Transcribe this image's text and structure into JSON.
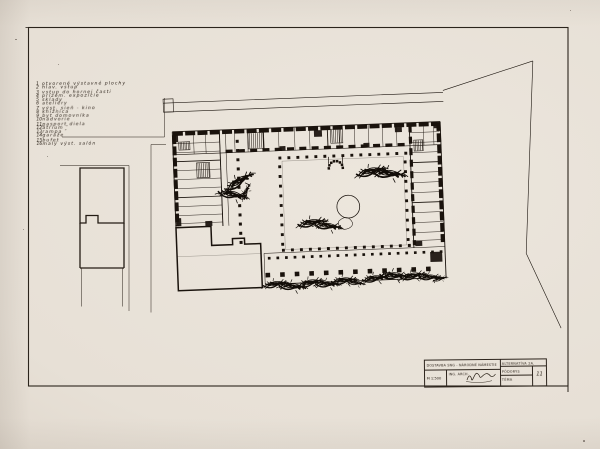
{
  "colors": {
    "paper": "#e8e1d8",
    "ink": "#1a130d",
    "frame_line": "#2b241c"
  },
  "legend": {
    "items": [
      {
        "num": "1",
        "label": "otvorené výstavné plochy"
      },
      {
        "num": "2",
        "label": "hlav. vstup"
      },
      {
        "num": "3",
        "label": "vstup do hornej časti"
      },
      {
        "num": "4",
        "label": "prízem. expozície"
      },
      {
        "num": "5",
        "label": "sklady"
      },
      {
        "num": "6",
        "label": "ateliéry"
      },
      {
        "num": "7",
        "label": "výst. sieň - kino"
      },
      {
        "num": "8",
        "label": "knižnica"
      },
      {
        "num": "9",
        "label": "byt domovníka"
      },
      {
        "num": "10",
        "label": "nádvorie"
      },
      {
        "num": "11",
        "label": "pasport diela"
      },
      {
        "num": "12",
        "label": "átrium ″"
      },
      {
        "num": "13",
        "label": "rampa ″"
      },
      {
        "num": "14",
        "label": "garáže"
      },
      {
        "num": "15",
        "label": "bufet"
      },
      {
        "num": "16",
        "label": "malý výst. salón"
      }
    ]
  },
  "title_block": {
    "project": "DOSTAVBA SNG - NÁRODNÉ NÁMESTIE",
    "scale": "M 1:500",
    "author": "ING. ARCH.",
    "alternative": "ALTERNATÍVA 2A.",
    "drawing_type": "PÔDORYS",
    "theme_label": "TÉMA",
    "sheet_number": "11"
  },
  "symbols": {
    "tree": "scribble-tree-symbol",
    "fountain": "fountain-circle",
    "stairs": "hatched-stair-block",
    "columns": "column-dot-grid"
  }
}
